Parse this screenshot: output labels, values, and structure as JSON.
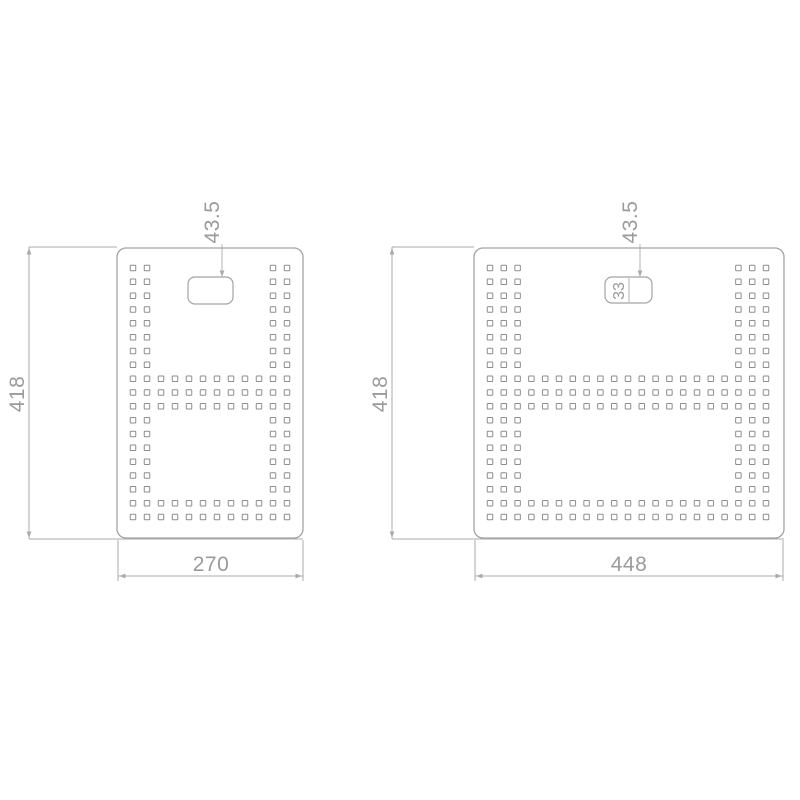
{
  "style": {
    "bg_color": "#ffffff",
    "outline_color": "#a3a3a3",
    "dim_color": "#ababab",
    "text_color": "#9b9b9b",
    "hole_color": "#8d8d8d"
  },
  "drawing": {
    "type": "technical-dimension-drawing",
    "description": "Two perforated panels with square hole pattern, centered handle slot and linear dimensions",
    "views": [
      {
        "name": "perforated-panel-270",
        "height_label": "418",
        "width_label": "270",
        "slot_offset_label": "43.5",
        "holes": {
          "size": 5.5,
          "row_ys": [
            268,
            281.8,
            295.7,
            309.5,
            323.3,
            337.2,
            351,
            364.8,
            378.7,
            392.5,
            406.3,
            420.2,
            434,
            447.8,
            461.7,
            475.5,
            489.3,
            503.2,
            517
          ],
          "col_xs": [
            133,
            147,
            161,
            175,
            189,
            203,
            217,
            231,
            245,
            259,
            273,
            287
          ],
          "edge_col_idx": [
            0,
            1,
            10,
            11
          ],
          "full_row_idx": [
            8,
            9,
            10,
            17,
            18
          ]
        }
      },
      {
        "name": "perforated-panel-448",
        "height_label": "418",
        "width_label": "448",
        "slot_offset_label": "43.5",
        "slot_height_label": "33",
        "holes": {
          "size": 5.5,
          "row_ys": [
            268,
            281.8,
            295.7,
            309.5,
            323.3,
            337.2,
            351,
            364.8,
            378.7,
            392.5,
            406.3,
            420.2,
            434,
            447.8,
            461.7,
            475.5,
            489.3,
            503.2,
            517
          ],
          "col_xs": [
            490,
            503.8,
            517.6,
            531.4,
            545.2,
            559,
            572.8,
            586.6,
            600.4,
            614.2,
            628,
            641.8,
            655.6,
            669.4,
            683.2,
            697,
            710.8,
            724.6,
            738.4,
            752.2,
            766
          ],
          "edge_col_idx": [
            0,
            1,
            2,
            18,
            19,
            20
          ],
          "full_row_idx": [
            8,
            9,
            10,
            17,
            18
          ]
        }
      }
    ]
  }
}
